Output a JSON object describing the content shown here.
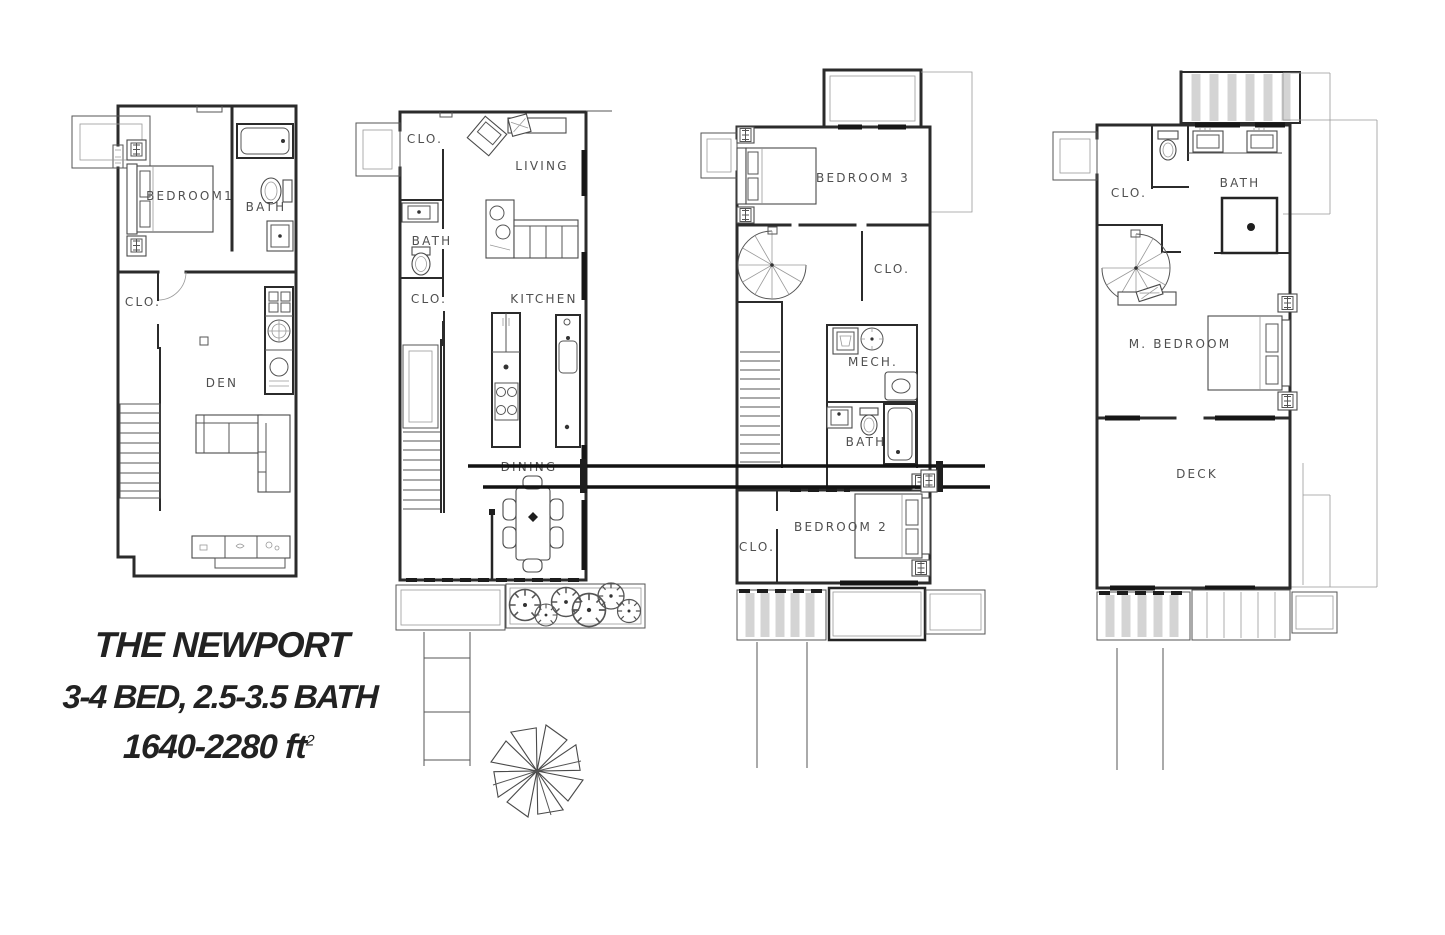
{
  "title": {
    "line1": "THE NEWPORT",
    "line2": "3-4 BED, 2.5-3.5 BATH",
    "line3_base": "1640-2280 ft",
    "line3_sup": "2"
  },
  "plans": {
    "p1": {
      "bedroom": "BEDROOM1",
      "bath": "BATH",
      "closet": "CLO.",
      "den": "DEN"
    },
    "p2": {
      "closet_top": "CLO.",
      "living": "LIVING",
      "bath": "BATH",
      "closet_mid": "CLO.",
      "kitchen": "KITCHEN",
      "dining": "DINING"
    },
    "p3": {
      "bedroom3": "BEDROOM 3",
      "closet_top": "CLO.",
      "mech": "MECH.",
      "bath": "BATH",
      "closet_bottom": "CLO.",
      "bedroom2": "BEDROOM 2"
    },
    "p4": {
      "closet": "CLO.",
      "bath": "BATH",
      "master_bedroom": "M. BEDROOM",
      "deck": "DECK"
    }
  },
  "colors": {
    "ink": "#2b2b2b",
    "label_gray": "#4f4f4f",
    "porch_stripe": "#d4d4d4",
    "background": "#ffffff"
  }
}
